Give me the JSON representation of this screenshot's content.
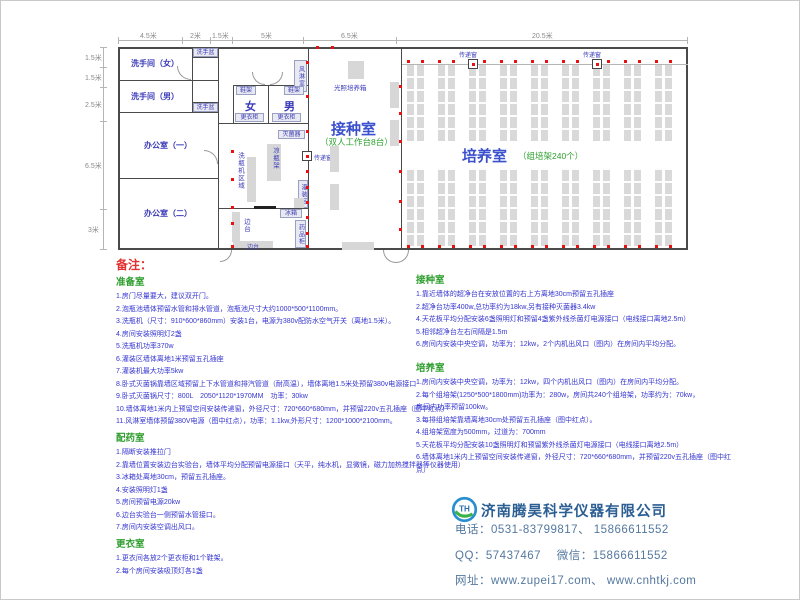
{
  "plan": {
    "dims_top": [
      "4.5米",
      "2米",
      "1.5米",
      "5米",
      "6.5米",
      "20.5米"
    ],
    "dims_left": [
      "1.5米",
      "1.5米",
      "2.5米",
      "6.5米",
      "3米"
    ],
    "rooms": {
      "toilet_female": "洗手间（女）",
      "toilet_male": "洗手间（男）",
      "sink_top": "洗手盆",
      "sink_bottom": "洗手盆",
      "office_1": "办公室（一）",
      "office_2": "办公室（二）",
      "air_shower": "风淋室",
      "female": "女",
      "male": "男",
      "inoculation_room": "接种室",
      "inoculation_sub": "（双人工作台8台）",
      "culture_room": "培养室",
      "culture_sub": "（组培架240个）"
    },
    "equipment": {
      "shoe_rack_1": "鞋架",
      "shoe_rack_2": "鞋架",
      "locker_1": "更衣柜",
      "locker_2": "更衣柜",
      "sterilizer": "灭菌器",
      "cooling_rack": "凉瓶架",
      "bottle_washer_area": "洗瓶机区域",
      "filling_area": "灌装区",
      "fridge": "冰箱",
      "side_bench_v": "边台",
      "side_bench_h": "边台",
      "medicine_cabinet": "药品柜",
      "light_incubator": "光照培养箱",
      "pass_window_1": "传递窗",
      "pass_window_2": "传递窗",
      "pass_window_3": "传递窗"
    }
  },
  "notes": {
    "title": "备注：",
    "sections": [
      {
        "heading": "准备室",
        "items": [
          "1.房门尽量要大，建议双开门。",
          "2.泡瓶池墙体预留水管和排水管道，泡瓶池尺寸大约1000*500*1100mm。",
          "3.洗瓶机（尺寸：910*600*860mm）安装1台，电源为380v配防水空气开关（离地1.5米）。",
          "4.房间安装照明灯2盏",
          "5.洗瓶机功率370w",
          "6.灌装区墙体离地1米预留五孔插座",
          "7.灌装机最大功率5kw",
          "8.卧式灭菌锅靠墙区域预留上下水管道和排汽管道（耐高温），墙体离地1.5米处预留380v电源接口",
          "9.卧式灭菌锅尺寸：800L　2050*1120*1970MM　功率：30kw",
          "10.墙体离地1米内上预留空间安装传递窗，外径尺寸：720*660*680mm，并预留220v五孔插座（图中红点）",
          "11.风淋室墙体预留380V电源（图中红点），功率：1.1kw,外形尺寸：1200*1000*2100mm。"
        ]
      },
      {
        "heading": "配药室",
        "items": [
          "1.隔断安装推拉门",
          "2.靠墙位置安装边台实验台，墙体平均分配预留电源接口（天平，纯水机，显微镜，磁力加热搅拌器等仪器使用）",
          "3.冰箱处离地30cm，预留五孔插座。",
          "4.安装照明灯1盏",
          "5.房间预留电源20kw",
          "6.边台实验台一侧预留水管接口。",
          "7.房间内安装空调出风口。"
        ]
      },
      {
        "heading": "更衣室",
        "items": [
          "1.更衣间各放2个更衣柜和1个鞋架。",
          "2.每个房间安装吸顶灯各1盏"
        ]
      },
      {
        "heading": "接种室",
        "items": [
          "1.靠近墙体的超净台在安放位置的右上方离地30cm预留五孔插座",
          "2.超净台功率400w,总功率约为18kw,另有接种灭菌器3.4kw",
          "4.天花板平均分配安装6盏照明灯和预留4盏紫外线杀菌灯电源接口（电线接口离地2.5m）",
          "5.相邻超净台左右间隔是1.5m",
          "6.房间内安装中央空调，功率为：12kw，2个内机出风口（图内）在房间内平均分配。"
        ]
      },
      {
        "heading": "培养室",
        "items": [
          "1.房间内安装中央空调，功率为：12kw，四个内机出风口（图内）在房间内平均分配。",
          "2.每个组培架(1250*500*1800mm)功率为：280w，房间共240个组培架，功率约为：70kw，",
          "房间内功率预留100kw。",
          "3.每排组培架靠墙离地30cm处预留五孔插座（图中红点）。",
          "4.组培架宽度为500mm，过道为：700mm",
          "5.天花板平均分配安装10盏照明灯和预留紫外线杀菌灯电源接口（电线接口离地2.5m）",
          "6.墙体离地1米内上预留空间安装传递窗，外径尺寸：720*660*680mm，并预留220v五孔插座（图中红点）"
        ]
      }
    ]
  },
  "company": {
    "logo_text": "TH",
    "name": "济南腾昊科学仪器有限公司",
    "phone": "电话：0531-83799817、 15866611552",
    "qq_wechat": "QQ：57437467　 微信：15866611552",
    "website": "网址：www.zupei17.com、 www.cnhtkj.com"
  },
  "colors": {
    "note_text": "#3535cf",
    "heading_green": "#2e9e2e",
    "remark_red": "#e03030",
    "label_blue": "#3a3ab8",
    "wall_gray": "#4a4a4a",
    "outlet_red": "#e81111",
    "company_blue": "#2b5e93"
  }
}
